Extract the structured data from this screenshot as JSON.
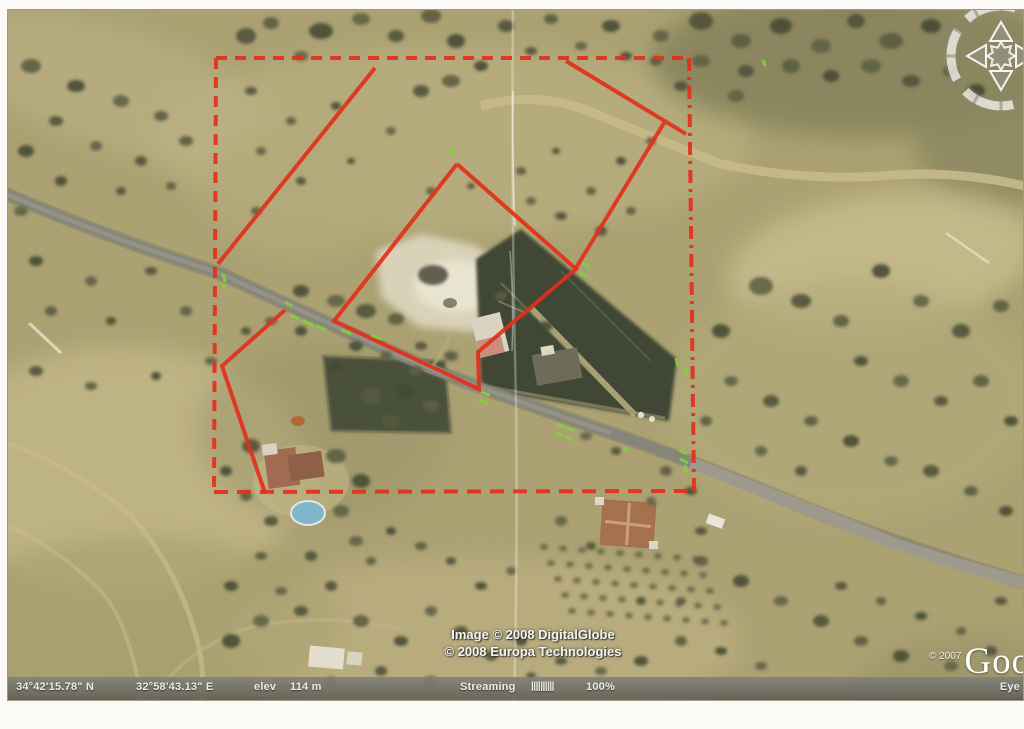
{
  "status_bar": {
    "latitude": "34°42'15.78\" N",
    "longitude": "32°58'43.13\" E",
    "elevation_label": "elev",
    "elevation_value": "114 m",
    "streaming_label": "Streaming",
    "streaming_bars": "||||||||||",
    "streaming_percent": "100%",
    "eye_label": "Eye"
  },
  "attribution": {
    "line1": "Image © 2008 DigitalGlobe",
    "line2": "© 2008 Europa Technologies"
  },
  "logo": {
    "copyright": "© 2007",
    "brand": "Goog"
  },
  "colors": {
    "annotation_red": "#e2301b",
    "tick_green": "#84cf3e",
    "pool_blue": "#7fb6c9",
    "status_text": "#f4f4ef",
    "terrain_base": "#aba173",
    "dark_field": "#3f4734"
  },
  "map_overlay": {
    "dashed_rectangle": {
      "edges": [
        {
          "points": [
            [
              215,
              57
            ],
            [
              688,
              57
            ]
          ],
          "dash": "11 8"
        },
        {
          "points": [
            [
              215,
              57
            ],
            [
              213,
              491
            ]
          ],
          "dash": "11 8"
        },
        {
          "points": [
            [
              213,
              491
            ],
            [
              693,
              490
            ]
          ],
          "dash": "14 9"
        },
        {
          "points": [
            [
              688,
              57
            ],
            [
              693,
              490
            ]
          ],
          "dash": "13 6 3 6"
        }
      ]
    },
    "solid_outlines": [
      {
        "points": [
          [
            374,
            67
          ],
          [
            217,
            263
          ]
        ]
      },
      {
        "points": [
          [
            284,
            309
          ],
          [
            221,
            365
          ],
          [
            264,
            492
          ]
        ]
      },
      {
        "points": [
          [
            456,
            163
          ],
          [
            575,
            268
          ],
          [
            477,
            351
          ],
          [
            478,
            388
          ],
          [
            333,
            320
          ],
          [
            456,
            163
          ]
        ]
      },
      {
        "points": [
          [
            565,
            60
          ],
          [
            685,
            133
          ]
        ]
      },
      {
        "points": [
          [
            663,
            122
          ],
          [
            575,
            267
          ]
        ]
      }
    ],
    "green_ticks": [
      [
        450,
        146,
        452,
        158
      ],
      [
        762,
        59,
        764,
        65
      ],
      [
        581,
        262,
        589,
        267
      ],
      [
        578,
        271,
        586,
        276
      ],
      [
        675,
        357,
        677,
        365
      ],
      [
        684,
        366,
        686,
        374
      ],
      [
        480,
        391,
        489,
        394
      ],
      [
        478,
        399,
        487,
        403
      ],
      [
        556,
        423,
        564,
        426
      ],
      [
        566,
        427,
        573,
        430
      ],
      [
        554,
        432,
        562,
        435
      ],
      [
        564,
        436,
        571,
        439
      ],
      [
        622,
        447,
        628,
        450
      ],
      [
        678,
        449,
        686,
        453
      ],
      [
        679,
        458,
        687,
        462
      ],
      [
        684,
        464,
        686,
        472
      ],
      [
        222,
        273,
        224,
        281
      ],
      [
        222,
        283,
        224,
        289
      ],
      [
        284,
        301,
        291,
        305
      ],
      [
        290,
        314,
        298,
        318
      ],
      [
        302,
        320,
        312,
        324
      ],
      [
        315,
        325,
        325,
        329
      ],
      [
        340,
        329,
        350,
        333
      ],
      [
        370,
        334,
        380,
        338
      ]
    ]
  }
}
